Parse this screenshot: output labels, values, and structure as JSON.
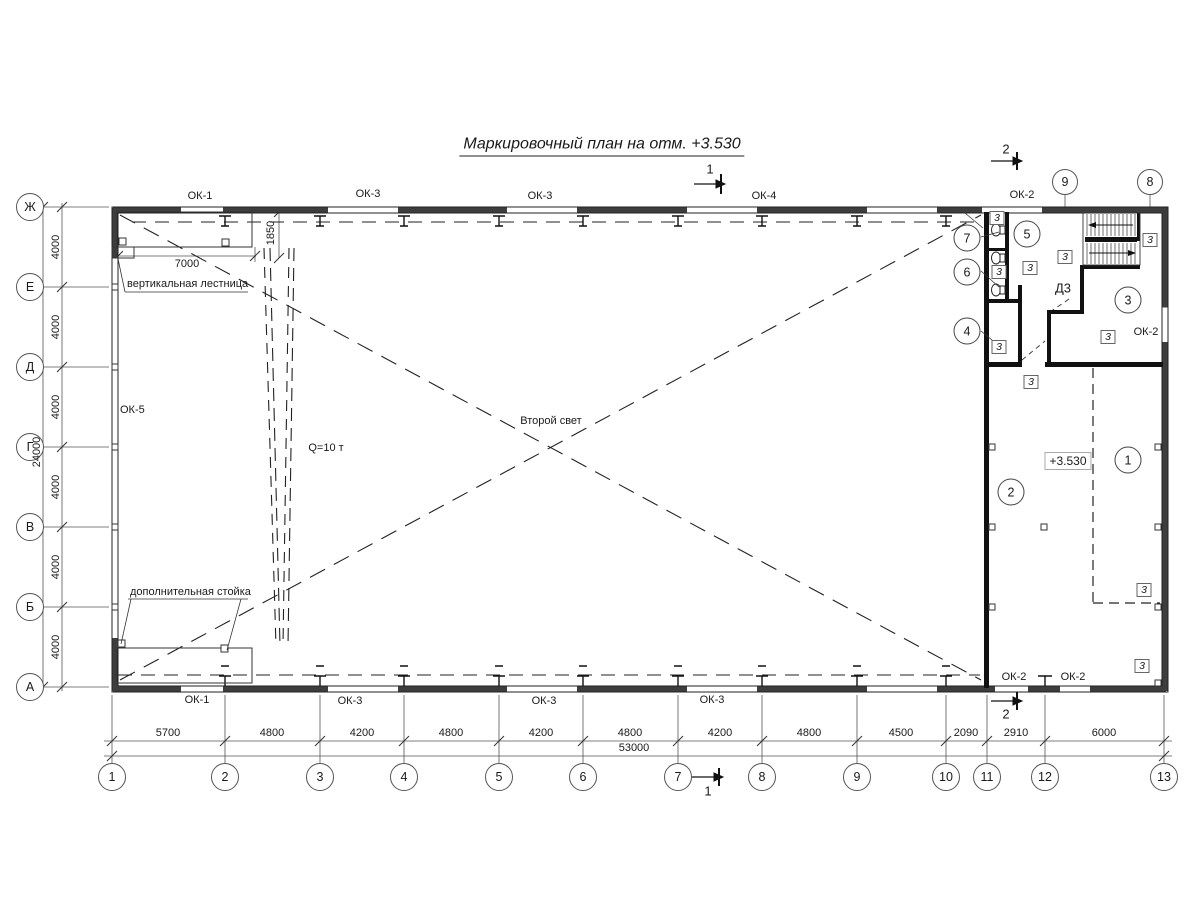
{
  "title": "Маркировочный план на отм. +3.530",
  "grid": {
    "columns": [
      "1",
      "2",
      "3",
      "4",
      "5",
      "6",
      "7",
      "8",
      "9",
      "10",
      "11",
      "12",
      "13"
    ],
    "rows": [
      "Ж",
      "Е",
      "Д",
      "Г",
      "В",
      "Б",
      "А"
    ],
    "top_refs": [
      "9",
      "8"
    ]
  },
  "dimensions": {
    "bottom": [
      "5700",
      "4800",
      "4200",
      "4800",
      "4200",
      "4800",
      "4200",
      "4800",
      "4500",
      "2090",
      "2910",
      "6000"
    ],
    "bottom_total": "53000",
    "left": [
      "4000",
      "4000",
      "4000",
      "4000",
      "4000",
      "4000"
    ],
    "left_total": "24000",
    "platform_width": "7000",
    "ladder_offset": "1850"
  },
  "windows": {
    "top": [
      "ОК-1",
      "ОК-3",
      "ОК-3",
      "ОК-4",
      "ОК-2"
    ],
    "bottom": [
      "ОК-1",
      "ОК-3",
      "ОК-3",
      "ОК-3"
    ],
    "bottom_right": [
      "ОК-2",
      "ОК-2"
    ],
    "left": "ОК-5",
    "right": "ОК-2"
  },
  "annotations": {
    "vertical_ladder": "вертикальная лестница",
    "extra_post": "дополнительная стойка",
    "second_light": "Второй свет",
    "crane_capacity": "Q=10 т",
    "door": "Д3",
    "elevation": "+3.530"
  },
  "rooms": [
    "1",
    "2",
    "3",
    "4",
    "5",
    "6",
    "7"
  ],
  "door_marks": [
    "3",
    "3",
    "3",
    "3",
    "3",
    "3",
    "3",
    "3",
    "3",
    "3"
  ],
  "sections": {
    "section1": "1",
    "section2": "2"
  }
}
